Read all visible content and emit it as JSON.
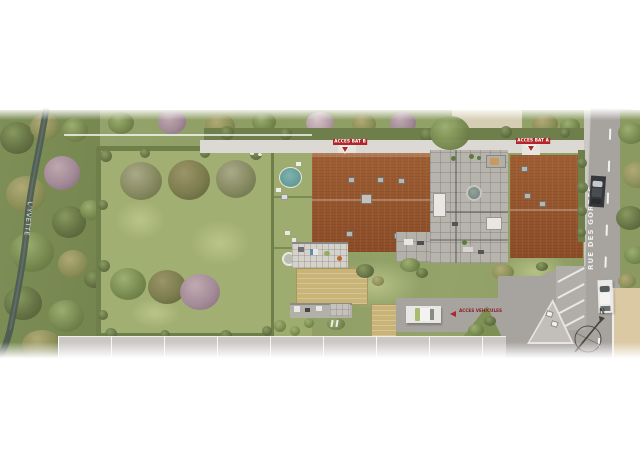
{
  "site_plan": {
    "river_label": "L'YVETTE",
    "street_label": "RUE DES GORDES",
    "access_building_b_label": "ACCES BAT B",
    "access_building_a_label": "ACCES BAT A",
    "vehicle_access_label": "ACCES VEHICULES",
    "compass_north_label": "N",
    "colors": {
      "accent_red": "#b0262b",
      "roof_terracotta": "#9a5a30",
      "lawn_green": "#93a267",
      "road_gray": "#a7a4a0",
      "water_dark": "#4d5a53",
      "sand_tan": "#c9b478",
      "pool_teal": "#6fa9a4",
      "neighbor_beige": "#dbc9a4"
    }
  }
}
